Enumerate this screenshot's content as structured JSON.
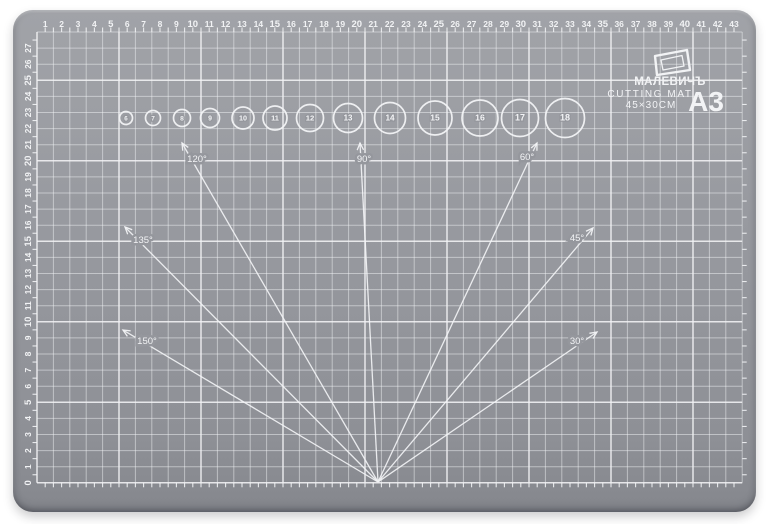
{
  "brand": {
    "name": "МАЛЕВИЧЪ",
    "product": "CUTTING MAT",
    "dimensions": "45×30CM",
    "format": "A3",
    "icon": "canvas-frame-icon"
  },
  "rulers": {
    "top_numbers": [
      1,
      2,
      3,
      4,
      5,
      6,
      7,
      8,
      9,
      10,
      11,
      12,
      13,
      14,
      15,
      16,
      17,
      18,
      19,
      20,
      21,
      22,
      23,
      24,
      25,
      26,
      27,
      28,
      29,
      30,
      31,
      32,
      33,
      34,
      35,
      36,
      37,
      38,
      39,
      40,
      41,
      42,
      43
    ],
    "left_numbers": [
      0,
      1,
      2,
      3,
      4,
      5,
      6,
      7,
      8,
      9,
      10,
      11,
      12,
      13,
      14,
      15,
      16,
      17,
      18,
      19,
      20,
      21,
      22,
      23,
      24,
      25,
      26,
      27
    ]
  },
  "circle_templates": {
    "labels": [
      "6",
      "7",
      "8",
      "9",
      "10",
      "11",
      "12",
      "13",
      "14",
      "15",
      "16",
      "17",
      "18"
    ]
  },
  "angle_guides": {
    "labels": [
      "150°",
      "135°",
      "120°",
      "90°",
      "60°",
      "45°",
      "30°"
    ]
  },
  "colors": {
    "mat_gray": "#95979d",
    "line_white": "#f2f3f5",
    "background": "#ffffff"
  }
}
